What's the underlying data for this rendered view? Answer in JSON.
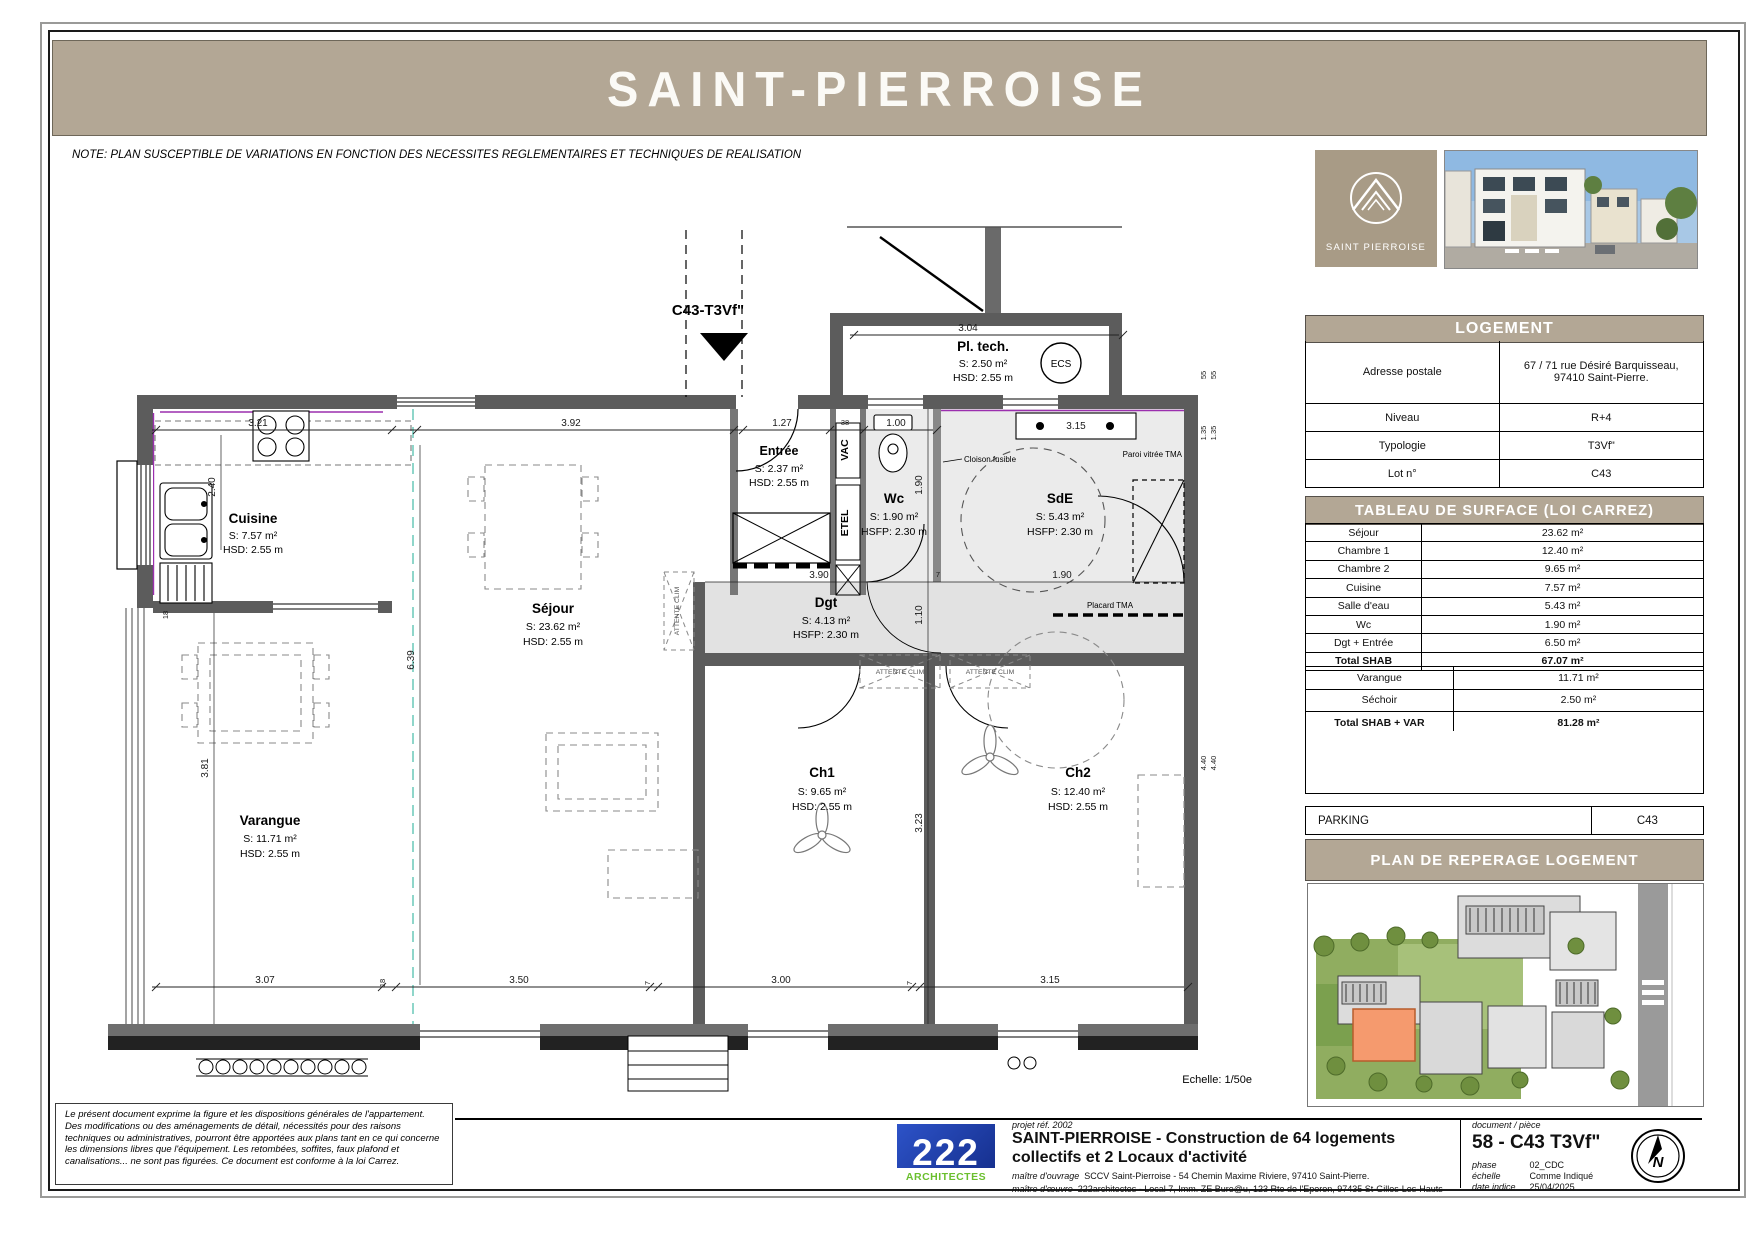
{
  "header": {
    "title": "SAINT-PIERROISE"
  },
  "note": "NOTE: PLAN SUSCEPTIBLE DE VARIATIONS EN FONCTION DES NECESSITES REGLEMENTAIRES ET TECHNIQUES DE REALISATION",
  "colors": {
    "band_taupe": "#b3a795",
    "logo_taupe": "#a89b86",
    "wall_gray": "#5c5c5c",
    "wet_room_fill": "#ebebeb",
    "highlight_unit_orange": "#f59a6e",
    "logo_blue": "#2d53c8",
    "logo_green": "#6abf2e"
  },
  "plan": {
    "unit": "C43-T3Vf\"",
    "echelle": "Echelle: 1/50e",
    "rooms": {
      "cuisine": {
        "n": "Cuisine",
        "s": "S: 7.57 m²",
        "h": "HSD: 2.55 m"
      },
      "sejour": {
        "n": "Séjour",
        "s": "S: 23.62 m²",
        "h": "HSD: 2.55 m"
      },
      "varangue": {
        "n": "Varangue",
        "s": "S: 11.71 m²",
        "h": "HSD: 2.55 m"
      },
      "entree": {
        "n": "Entrée",
        "s": "S: 2.37 m²",
        "h": "HSD: 2.55 m"
      },
      "pltech": {
        "n": "Pl. tech.",
        "s": "S: 2.50 m²",
        "h": "HSD: 2.55 m"
      },
      "wc": {
        "n": "Wc",
        "s": "S: 1.90 m²",
        "h": "HSFP: 2.30 m"
      },
      "sde": {
        "n": "SdE",
        "s": "S: 5.43 m²",
        "h": "HSFP: 2.30 m"
      },
      "dgt": {
        "n": "Dgt",
        "s": "S: 4.13 m²",
        "h": "HSFP: 2.30 m"
      },
      "ch1": {
        "n": "Ch1",
        "s": "S: 9.65 m²",
        "h": "HSD: 2.55 m"
      },
      "ch2": {
        "n": "Ch2",
        "s": "S: 12.40 m²",
        "h": "HSD: 2.55 m"
      }
    },
    "labels": {
      "vac": "VAC",
      "etel": "ETEL",
      "ecs": "ECS",
      "cloison": "Cloison fusible",
      "paroi": "Paroi vitrée TMA",
      "placard": "Placard TMA",
      "attente": "ATTENTE CLIM"
    },
    "dims": {
      "top321": "3.21",
      "top392": "3.92",
      "top127": "1.27",
      "top38": "38",
      "top100": "1.00",
      "pltech304": "3.04",
      "basin315": "3.15",
      "v190": "1.90",
      "v110": "1.10",
      "v323": "3.23",
      "dgt390": "3.90",
      "dgt7": "7",
      "placard190": "1.90",
      "left240": "2.40",
      "left18": "18",
      "left381": "3.81",
      "mid639": "6.39",
      "bot307": "3.07",
      "bot18": "18",
      "bot350": "3.50",
      "bot7a": "7",
      "bot300": "3.00",
      "bot7b": "7",
      "bot315": "3.15",
      "r55a": "55",
      "r55b": "55",
      "r135a": "1.35",
      "r135b": "1.35",
      "r440a": "4.40",
      "r440b": "4.40"
    }
  },
  "sidebar": {
    "logo_caption": "SAINT PIERROISE",
    "logement": {
      "title": "LOGEMENT",
      "rows": [
        {
          "label": "Adresse postale",
          "value": "67 / 71 rue Désiré Barquisseau,\n97410 Saint-Pierre."
        },
        {
          "label": "Niveau",
          "value": "R+4"
        },
        {
          "label": "Typologie",
          "value": "T3Vf\""
        },
        {
          "label": "Lot n°",
          "value": "C43"
        }
      ]
    },
    "surface": {
      "title": "TABLEAU DE SURFACE (LOI CARREZ)",
      "rows": [
        {
          "label": "Séjour",
          "value": "23.62 m²"
        },
        {
          "label": "Chambre 1",
          "value": "12.40 m²"
        },
        {
          "label": "Chambre 2",
          "value": "9.65 m²"
        },
        {
          "label": "Cuisine",
          "value": "7.57 m²"
        },
        {
          "label": "Salle d'eau",
          "value": "5.43 m²"
        },
        {
          "label": "Wc",
          "value": "1.90 m²"
        },
        {
          "label": "Dgt + Entrée",
          "value": "6.50 m²"
        },
        {
          "label": "Total SHAB",
          "value": "67.07 m²"
        }
      ],
      "rows2": [
        {
          "label": "Varangue",
          "value": "11.71 m²"
        },
        {
          "label": "Séchoir",
          "value": "2.50 m²"
        },
        {
          "label": "Total SHAB + VAR",
          "value": "81.28 m²"
        }
      ]
    },
    "parking": {
      "label": "PARKING",
      "value": "C43"
    },
    "reperage_title": "PLAN DE REPERAGE LOGEMENT"
  },
  "footer": {
    "disclaimer": "Le présent document exprime la figure et les dispositions générales de l'appartement. Des modifications ou des aménagements de détail, nécessités pour des raisons techniques ou administratives, pourront être apportées aux plans tant en ce qui concerne les dimensions libres que l'équipement. Les retombées, soffites, faux plafond et canalisations... ne sont pas figurées. Ce document est conforme à la loi Carrez.",
    "logo_number": "222",
    "logo_word": "ARCHITECTES",
    "projet_ref": "projet réf. 2002",
    "title_line1": "SAINT-PIERROISE -  Construction de 64 logements",
    "title_line2": "collectifs et 2 Locaux d'activité",
    "moa_label": "maître d'ouvrage",
    "moa": "SCCV Saint-Pierroise - 54 Chemin Maxime Riviere, 97410 Saint-Pierre.",
    "moe_label": "maître d'œuvre",
    "moe": "222architectes - Local 7, Imm. ZE Bure@u, 123 Rte de l'Eperon, 97435 St-Gilles-Les-Hauts",
    "doc_label": "document / pièce",
    "doc_value": "58 - C43 T3Vf\"",
    "phase_label": "phase",
    "phase": "02_CDC",
    "echelle_label": "échelle",
    "echelle": "Comme Indiqué",
    "date_label": "date indice",
    "date": "25/04/2025",
    "north": "N"
  }
}
